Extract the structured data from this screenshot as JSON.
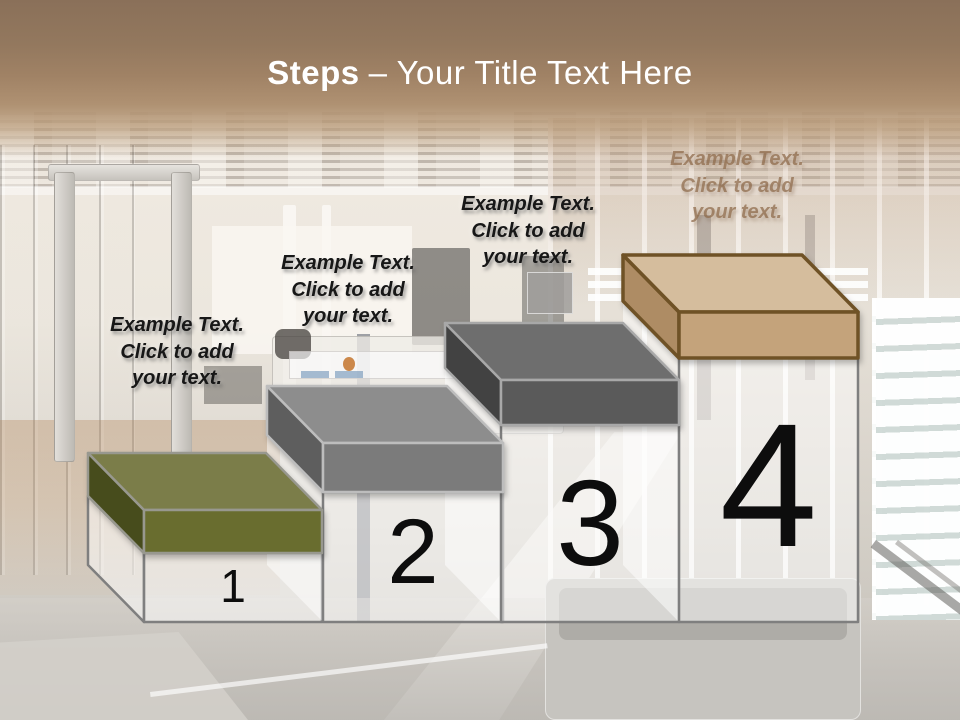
{
  "title": {
    "emphasis": "Steps",
    "rest": "– Your Title Text Here",
    "color": "#ffffff"
  },
  "theme": {
    "header_gradient_top": "#8a7059",
    "header_gradient_bottom": "#b99b7d",
    "label_color": "#171717",
    "label_faded_color": "#8d6a4a",
    "number_color": "#0d0d0d",
    "column_fill": "rgba(255,255,255,0.5)",
    "column_outline": "#7f7f7f"
  },
  "steps": [
    {
      "number": "1",
      "label_lines": [
        "Example Text.",
        "Click  to add",
        "your text."
      ],
      "colors": {
        "top": "#7b7d49",
        "side": "#474c1c",
        "front": "#696d2f",
        "outline": "#98988f"
      }
    },
    {
      "number": "2",
      "label_lines": [
        "Example Text.",
        "Click  to add",
        "your text."
      ],
      "colors": {
        "top": "#8d8d8d",
        "side": "#5e5e5e",
        "front": "#7b7b7b",
        "outline": "#bdbdbd"
      }
    },
    {
      "number": "3",
      "label_lines": [
        "Example Text.",
        "Click  to add",
        "your text."
      ],
      "colors": {
        "top": "#6e6e6e",
        "side": "#424242",
        "front": "#5a5a5a",
        "outline": "#a8a8a8"
      }
    },
    {
      "number": "4",
      "label_lines": [
        "Example Text.",
        "Click  to add",
        "your text."
      ],
      "colors": {
        "top": "#d5bd9d",
        "side": "#ae8c64",
        "front": "#c4a37b",
        "outline": "#6f5226"
      }
    }
  ]
}
